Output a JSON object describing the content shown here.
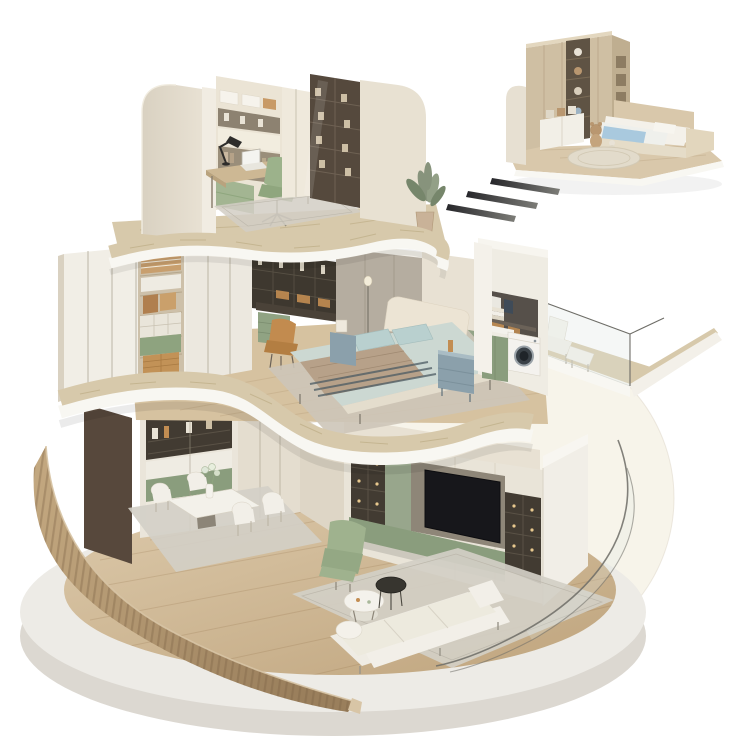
{
  "meta": {
    "type": "3d-isometric-interior-cutaway-render",
    "description": "Three-storey circular cutaway dollhouse interior render with detached kids bedroom vignette"
  },
  "colors": {
    "bg": "#ffffff",
    "backdrop": "#f7f4ea",
    "platform_top": "#edebe6",
    "platform_side": "#dcd8d1",
    "deck_a": "#dcc9aa",
    "deck_b": "#bfa47d",
    "plank": "#8a6b42",
    "slat_a": "#c4a981",
    "slat_b": "#9a7f5c",
    "slat_cut": "#d8c5a6",
    "trav": "#d7c9ab",
    "trav_streak": "#b9a87f",
    "fascia": "#f8f7f2",
    "cream": "#e8e1d3",
    "cream_light": "#f2ede3",
    "cream_dark": "#d9d1c1",
    "wardrobe": "#f1eee6",
    "seam": "#a29a87",
    "closet": "#cdc0a9",
    "shelfline": "#b5a78d",
    "dark_shelf": "#423b32",
    "cell_line": "#5a5246",
    "amber": "#c28d52",
    "amber_dark": "#a87a42",
    "sage": "#9fb28e",
    "sage_dark": "#8fa67e",
    "sage_cab": "#8a9d7d",
    "sage_panel": "#98a68c",
    "recess": "#8e8678",
    "tv": "#17171b",
    "glow": "#e8c88e",
    "gray_panel": "#b5ada0",
    "gray_seam": "#a39b8d",
    "bed_cream": "#ece4d4",
    "bedding": "#ccd8d2",
    "pillowc": "#b9d0cf",
    "throw": "#b7a189",
    "stripe": "#4c5b63",
    "nightstand": "#8ba0ab",
    "nightstand_top": "#a9bcc4",
    "rug": "#d3cfc6",
    "rug_line": "#bdb8ac",
    "orange": "#c28b4f",
    "orange_dark": "#b37e42",
    "kids_wood": "#cfbfa3",
    "kids_dark": "#5f5344",
    "kids_side": "#bfae90",
    "kids_plank": "#b5a285",
    "blue": "#a9c9de",
    "teddy": "#b99770",
    "teddy2": "#c4a47d",
    "glassline": "#6e6d67",
    "glass_fill": "#dfe7e2",
    "wood_floor2": "#d6c2a0",
    "divider": "#57483c",
    "white_f": "#f4f1ea",
    "washer_door": "#3a4147",
    "washer_ring": "#9aa2a8",
    "dash_a": "#26262a",
    "dash_b": "#7d7d78",
    "linen": "#eeebe2",
    "bag1": "#b07f4e",
    "bag2": "#caa06b"
  },
  "scene": {
    "base": {
      "platform": "circular concrete display platform",
      "floor": "light oak plank flooring",
      "backdrop": "warm cream circle backdrop",
      "surrounds": [
        "curved wood slat wall",
        "curved glass wall"
      ]
    },
    "levels": [
      {
        "name": "ground-floor",
        "rooms": [
          {
            "name": "dining-room",
            "furniture": [
              "dark wood divider panel",
              "sideboard hutch with display niches",
              "sage drawer band",
              "marble dining table",
              "four upholstered dining chairs",
              "flower vase",
              "area rug"
            ]
          },
          {
            "name": "living-room",
            "furniture": [
              "media wall with backlit display shelves",
              "flat-screen tv",
              "sage base cabinets",
              "white end pillar",
              "cream three-seat sofa",
              "round marble coffee table",
              "round glass side table",
              "sage recliner armchair",
              "large area rug"
            ]
          }
        ]
      },
      {
        "name": "second-floor",
        "rooms": [
          {
            "name": "master-bedroom",
            "furniture": [
              "white floor-to-ceiling wardrobe",
              "open closet with clothes, handbags, boxes and baskets",
              "dark display shelving with amber boxes",
              "vanity desk",
              "caramel desk chair",
              "sage drawer unit",
              "grey upholstered wall panels",
              "floor lamp",
              "upholstered bed with blue-grey bedding",
              "tan throw blanket",
              "two blue-grey nightstands",
              "sage accent wall",
              "bedroom rug"
            ]
          },
          {
            "name": "laundry-nook",
            "furniture": [
              "washing machine",
              "laundry counter",
              "hanging towels",
              "wicker baskets",
              "sage cabinet"
            ]
          },
          {
            "name": "balcony",
            "furniture": [
              "glass railing",
              "white lounge chair",
              "white ottoman",
              "cantilevered slab"
            ]
          }
        ]
      },
      {
        "name": "top-floor",
        "rooms": [
          {
            "name": "study",
            "furniture": [
              "curved cream walls",
              "built-in shelf wall with storage boxes",
              "sage daybed",
              "writing desk",
              "laptop",
              "black desk lamp",
              "sage task chair",
              "tall cream cabinet",
              "dark glass-door bookcase",
              "area rug",
              "potted plant"
            ]
          }
        ]
      }
    ],
    "vignette": {
      "name": "kids-bedroom",
      "furniture": [
        "wood wardrobe wall",
        "open toy shelf column with teddy bears",
        "white storage cabinet",
        "platform bed with blue blanket",
        "foot bench",
        "teddy bears",
        "round rug",
        "wood floor slab"
      ],
      "marks": "three diagonal motion dashes"
    }
  }
}
